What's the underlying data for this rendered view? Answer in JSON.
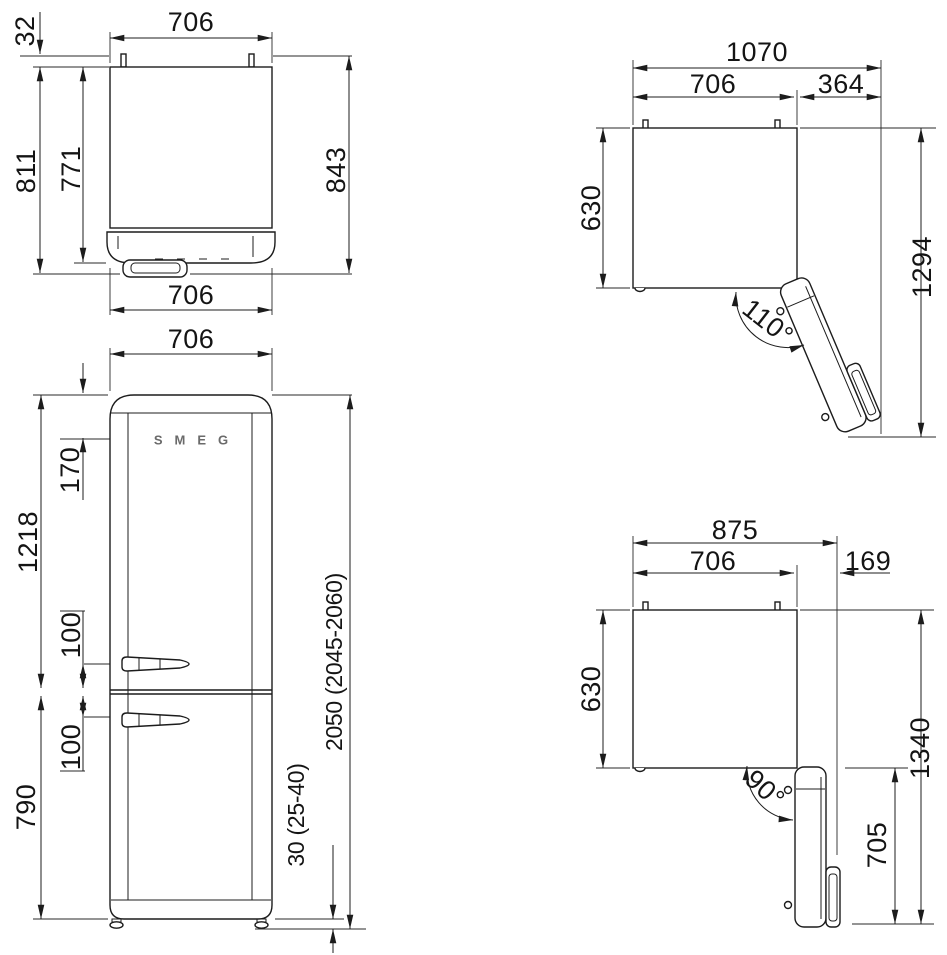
{
  "diagram": {
    "type": "refrigerator-installation-dimension-drawing",
    "units": "mm",
    "line_color": "#1c1c1c",
    "background": "#ffffff"
  },
  "views": {
    "top_closed": {
      "width_top": "706",
      "rear_clearance": "32",
      "depth_with_handle": "811",
      "depth_to_door_front": "771",
      "depth_total": "843",
      "width_bottom": "706"
    },
    "top_open_110": {
      "width_total": "1070",
      "width_body": "706",
      "door_clearance": "364",
      "depth_body": "630",
      "depth_total": "1294",
      "open_angle": "110°"
    },
    "front": {
      "width": "706",
      "logo_from_top": "170",
      "upper_section": "1218",
      "upper_handle_offset": "100",
      "lower_handle_offset": "100",
      "lower_section": "790",
      "total_height": "2050 (2045-2060)",
      "feet_height": "30 (25-40)",
      "brand": "SMEG"
    },
    "top_open_90": {
      "width_total": "875",
      "width_body": "706",
      "handle_clearance": "169",
      "depth_body": "630",
      "depth_total": "1340",
      "door_projection": "705",
      "open_angle": "90°"
    }
  }
}
